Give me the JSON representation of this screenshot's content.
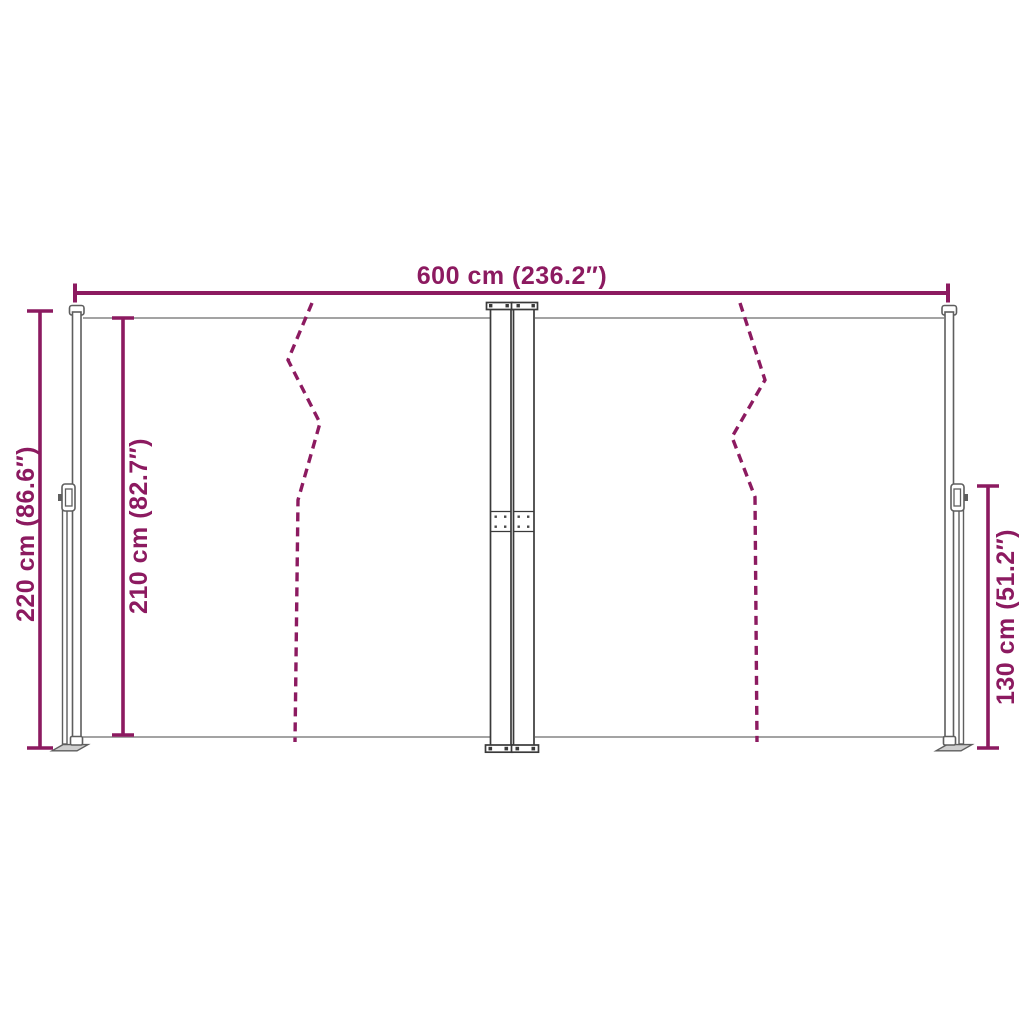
{
  "diagram": {
    "labels": {
      "width_top": "600 cm (236.2″)",
      "height_left_outer": "220 cm (86.6″)",
      "height_left_inner": "210 cm (82.7″)",
      "height_right": "130 cm (51.2″)"
    }
  },
  "colors": {
    "dimension_accent": "#8C1A60",
    "structure_line": "#5e5e5e",
    "cassette_line": "#3a3a3a",
    "fabric_edge": "#a3a3a3",
    "metal_fill": "#ffffff",
    "foot_fill": "#cfcfcf",
    "background": "#ffffff"
  }
}
